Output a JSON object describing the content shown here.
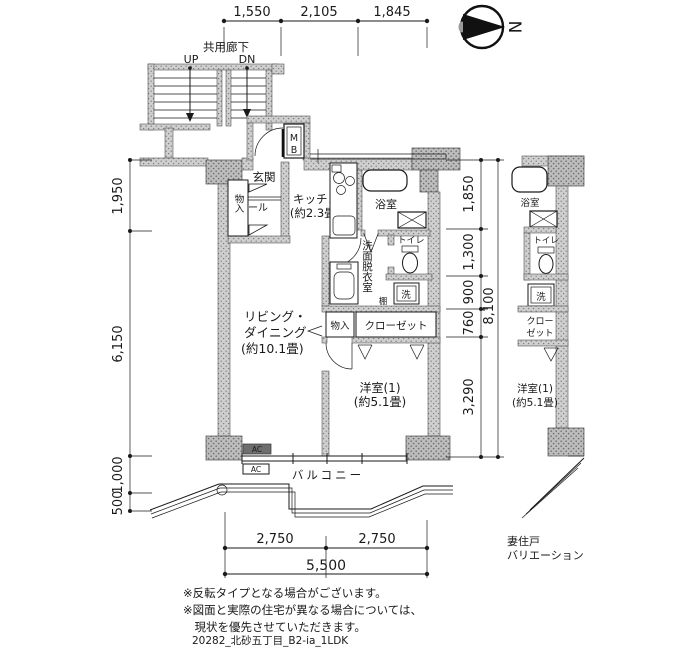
{
  "colors": {
    "ink": "#1a1a1a",
    "wall_fill": "#cfcfcf"
  },
  "compass": {
    "north_label": "N"
  },
  "dimensions": {
    "top": [
      "1,550",
      "2,105",
      "1,845"
    ],
    "left": [
      "1,950",
      "6,150",
      "1,000",
      "500"
    ],
    "right": [
      "1,850",
      "1,300",
      "900",
      "760",
      "3,290"
    ],
    "right_total": "8,100",
    "bottom": [
      "2,750",
      "2,750"
    ],
    "bottom_total": "5,500"
  },
  "corridor": {
    "label": "共用廊下",
    "up": "UP",
    "down": "DN"
  },
  "meter_box": {
    "line1": "M",
    "line2": "B"
  },
  "rooms": {
    "entrance": "玄関",
    "hall": "ホール",
    "storage_entrance": "物入",
    "kitchen_name": "キッチン",
    "kitchen_size": "(約2.3畳)",
    "bath": "浴室",
    "toilet": "トイレ",
    "washroom": "洗面脱衣室",
    "washer": "洗",
    "shelf": "棚",
    "living_line1": "リビング・",
    "living_line2": "ダイニング",
    "living_size": "(約10.1畳)",
    "storage_living": "物入",
    "closet": "クローゼット",
    "western_room": "洋室(1)",
    "western_size": "(約5.1畳)",
    "balcony": "バルコニー",
    "ac": "AC"
  },
  "mini_plan": {
    "bath": "浴室",
    "toilet": "トイレ",
    "washer": "洗",
    "closet_line1": "クロー",
    "closet_line2": "ゼット",
    "western_room": "洋室(1)",
    "western_size": "(約5.1畳)",
    "caption_line1": "妻住戸",
    "caption_line2": "バリエーション"
  },
  "notes": [
    "※反転タイプとなる場合がございます。",
    "※図面と実際の住宅が異なる場合については、",
    "　現状を優先させていただきます。"
  ],
  "plan_id": "20282_北砂五丁目_B2-ia_1LDK"
}
